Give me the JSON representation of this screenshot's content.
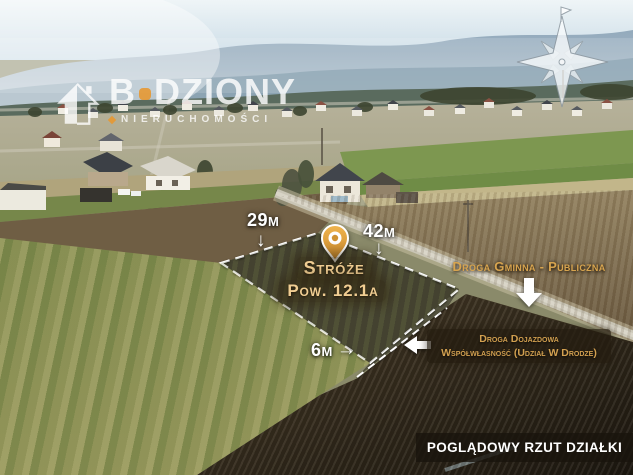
{
  "branding": {
    "prefix": "B",
    "suffix": "DZIONY",
    "subtitle": "NIERUCHOMOŚCI"
  },
  "plot": {
    "name": "Stróże",
    "area": "Pow. 12.1a"
  },
  "measurements": {
    "north_west_edge": "29m",
    "road_edge": "42m",
    "access_road_width": "6m"
  },
  "roads": {
    "public_road": "Droga Gminna - Publiczna",
    "access_line1": "Droga Dojazdowa",
    "access_line2": "Współwłasność (Udział W Drodze)"
  },
  "footer": {
    "caption": "POGLĄDOWY RZUT DZIAŁKI"
  },
  "icons": {
    "down_arrow": "↓",
    "right_arrow": "→"
  },
  "colors": {
    "gold_accent": "#d7a44f",
    "plot_label_cream": "#f1ce93",
    "label_white": "#ffffff",
    "pin_gold": "#d99a35",
    "dark_panel": "rgba(36,28,15,0.72)"
  }
}
